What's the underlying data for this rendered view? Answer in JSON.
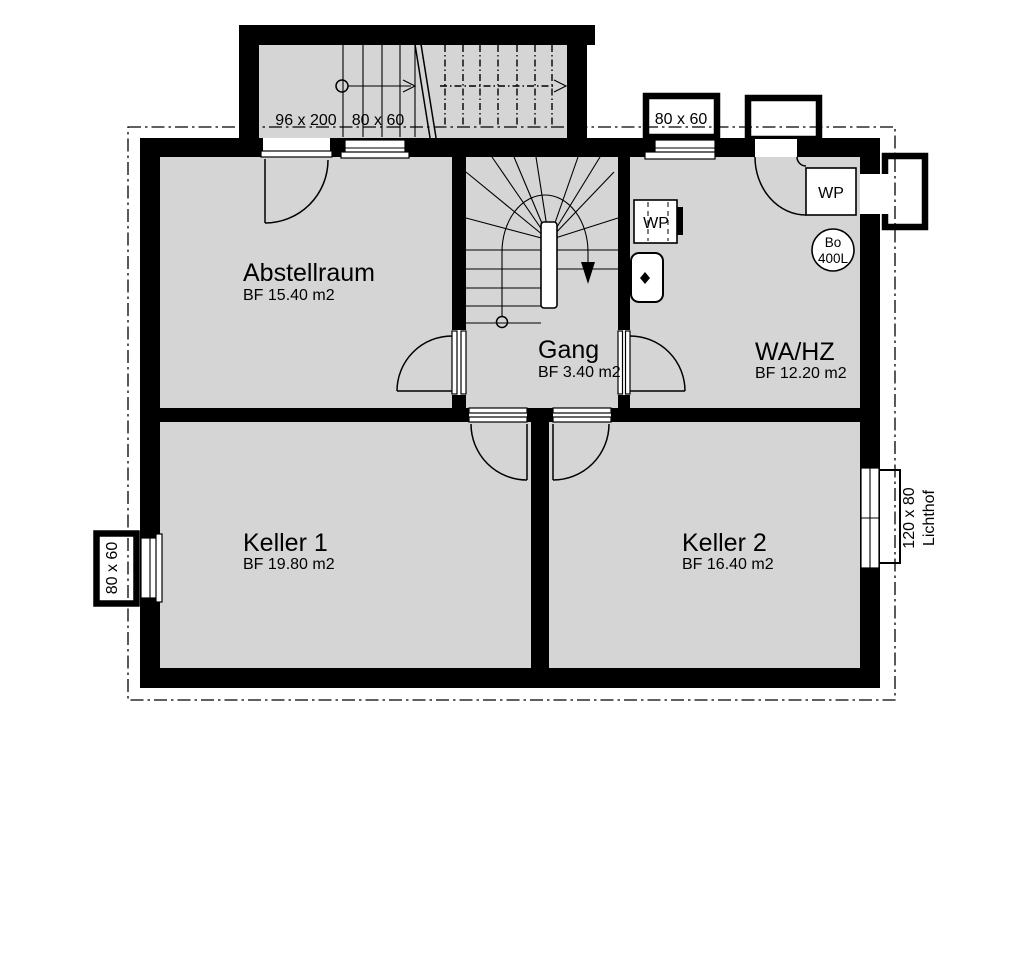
{
  "rooms": [
    {
      "name": "Abstellraum",
      "area": "BF 15.40 m2"
    },
    {
      "name": "Gang",
      "area": "BF 3.40 m2"
    },
    {
      "name": "WA/HZ",
      "area": "BF 12.20 m2"
    },
    {
      "name": "Keller 1",
      "area": "BF 19.80 m2"
    },
    {
      "name": "Keller 2",
      "area": "BF 16.40 m2"
    }
  ],
  "dimensions": {
    "entry_door": "96 x 200",
    "stair_window": "80 x 60",
    "wahz_window": "80 x 60",
    "keller1_window": "80 x 60",
    "lichthof_size": "120 x 80",
    "lichthof_label": "Lichthof"
  },
  "equipment": {
    "wp_inner": "WP",
    "wp_outer": "WP",
    "boiler_short": "Bo",
    "boiler_volume": "400L"
  },
  "colors": {
    "wall": "#000000",
    "floor": "#d5d5d5",
    "background": "#ffffff"
  }
}
